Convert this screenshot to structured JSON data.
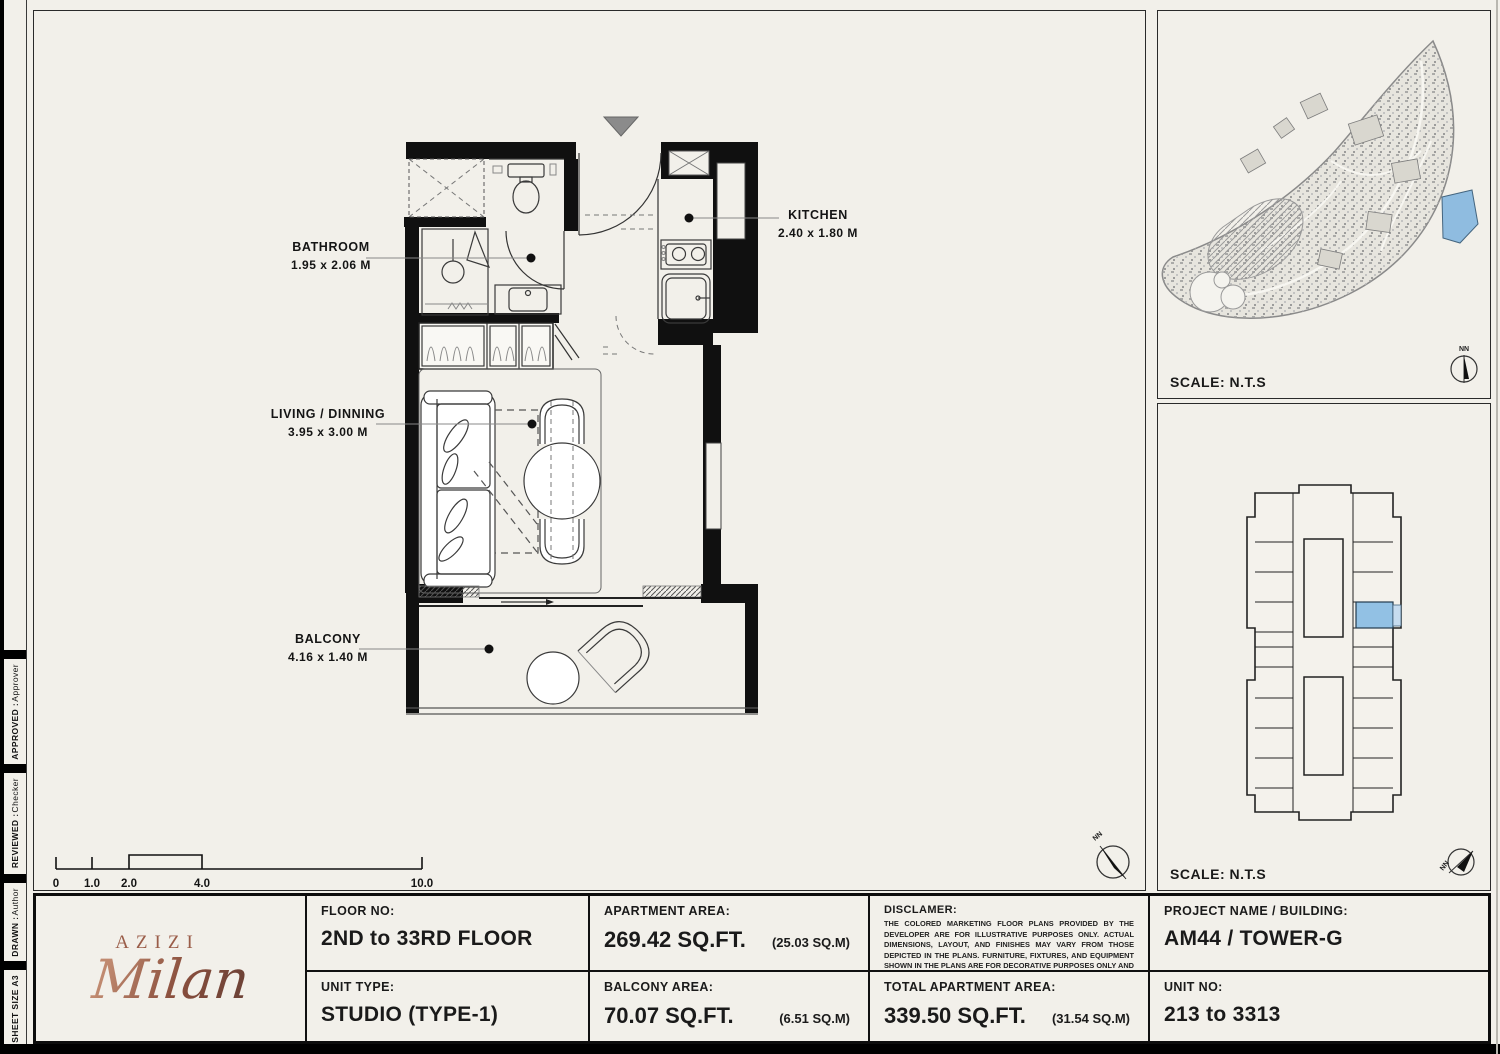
{
  "strip": {
    "approved_label": "APPROVED :",
    "approved_value": "Approver",
    "reviewed_label": "REVIEWED :",
    "reviewed_value": "Checker",
    "drawn_label": "DRAWN :",
    "drawn_value": "Author",
    "sheet_size": "SHEET SIZE A3"
  },
  "plan": {
    "rooms": [
      {
        "name": "BATHROOM",
        "dims": "1.95 x 2.06 M"
      },
      {
        "name": "KITCHEN",
        "dims": "2.40 x 1.80 M"
      },
      {
        "name": "LIVING / DINNING",
        "dims": "3.95 x 3.00 M"
      },
      {
        "name": "BALCONY",
        "dims": "4.16 x 1.40 M"
      }
    ],
    "scale_ticks": [
      "0",
      "1.0",
      "2.0",
      "4.0",
      "10.0"
    ],
    "north_label": "NN"
  },
  "site_map": {
    "scale_text": "SCALE: N.T.S",
    "north_label": "NN",
    "highlight_color": "#8fbce0"
  },
  "key_plan": {
    "scale_text": "SCALE: N.T.S",
    "north_label": "NN",
    "highlight_color": "#92c1e4"
  },
  "title_block": {
    "logo": {
      "brand": "AZIZI",
      "name": "Milan",
      "color": "#9a5d49"
    },
    "floor_no": {
      "label": "FLOOR NO:",
      "value": "2ND to 33RD FLOOR"
    },
    "unit_type": {
      "label": "UNIT TYPE:",
      "value": "STUDIO (TYPE-1)"
    },
    "apartment_area": {
      "label": "APARTMENT AREA:",
      "value": "269.42 SQ.FT.",
      "metric": "(25.03 SQ.M)"
    },
    "balcony_area": {
      "label": "BALCONY AREA:",
      "value": "70.07 SQ.FT.",
      "metric": "(6.51 SQ.M)"
    },
    "disclaimer": {
      "label": "DISCLAMER:",
      "text": "THE COLORED MARKETING FLOOR PLANS PROVIDED BY THE DEVELOPER ARE FOR ILLUSTRATIVE PURPOSES ONLY. ACTUAL DIMENSIONS, LAYOUT, AND FINISHES MAY VARY FROM THOSE DEPICTED IN THE PLANS. FURNITURE, FIXTURES, AND EQUIPMENT SHOWN IN THE PLANS ARE FOR DECORATIVE PURPOSES ONLY AND ARE NOT INCLUDED IN THE PURCHASE OR LEASE OF THE PROPERTY. THE DEVELOPER RESERVES THE RIGHT TO MAKE MODIFICATIONS, REVISIONS, AND CHANGES TO THE FLOOR PLANS, SPECIFICATIONS, AND FEATURES WITHOUT PRIOR NOTICE."
    },
    "total_area": {
      "label": "TOTAL APARTMENT AREA:",
      "value": "339.50 SQ.FT.",
      "metric": "(31.54 SQ.M)"
    },
    "project": {
      "label": "PROJECT NAME / BUILDING:",
      "value": "AM44 / TOWER-G"
    },
    "unit_no": {
      "label": "UNIT NO:",
      "value": "213 to 3313"
    }
  }
}
